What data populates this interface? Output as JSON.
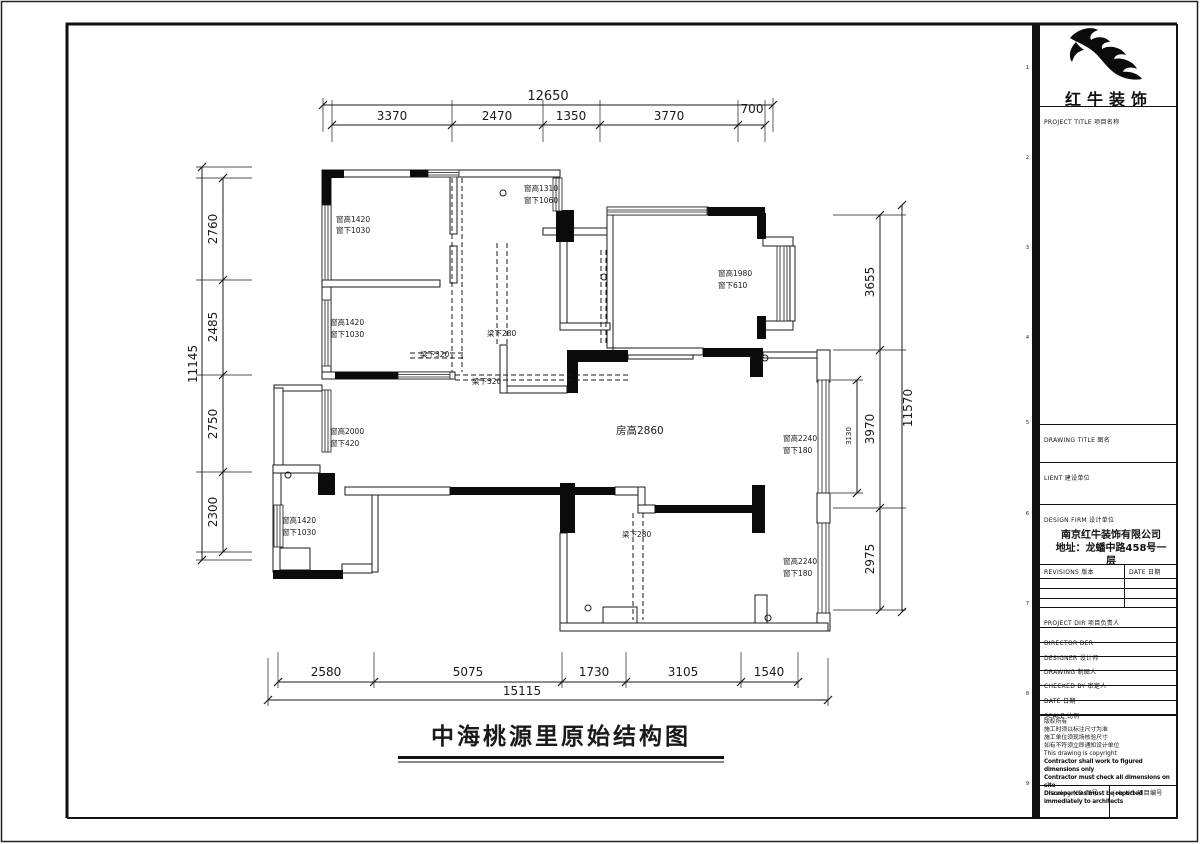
{
  "title_block": {
    "brand": "红牛装饰",
    "project_title": "PROJECT TITLE  项目名称",
    "drawing_title": "DRAWING TITLE  图名",
    "client": "LIENT  建设单位",
    "design_firm": "DESIGN FIRM  设计单位",
    "firm_name": "南京红牛装饰有限公司",
    "firm_addr1": "地址：龙蟠中路458号一",
    "firm_addr2": "层",
    "revisions": "REVISIONS  版本",
    "rev_date": "DATE  日期",
    "project_dir": "PROJECT DIR  项目负责人",
    "director": "DIRECTOR DER",
    "designer": "DESIGNER  设计师",
    "drawing": "DRAWING  制图人",
    "checked_by": "CHECKED BY  审定人",
    "date": "DATE  日期",
    "scale": "SCALE  比例",
    "notes": [
      "版权所有",
      "施工时须以标注尺寸为准",
      "施工单位须现场核验尺寸",
      "如有不符须立即通知设计单位",
      "This drawing is copyright",
      "Contractor shall work to figured dimensions only",
      "Contractor must check all dimensions on site",
      "Discrepancies must be reported immediately to architects"
    ],
    "drawing_no": "Drawing NO  图号",
    "job_no": "Job NO  项目编号",
    "grid_refs": [
      "1",
      "2",
      "3",
      "4",
      "5",
      "6",
      "7",
      "8",
      "9"
    ]
  },
  "plan": {
    "title": "中海桃源里原始结构图",
    "annotations": {
      "tl_win": {
        "l1": "窗高1420",
        "l2": "窗下1030"
      },
      "entry_win": {
        "l1": "窗高1310",
        "l2": "窗下1060"
      },
      "ml_win": {
        "l1": "窗高1420",
        "l2": "窗下1030"
      },
      "tr_win": {
        "l1": "窗高1980",
        "l2": "窗下610"
      },
      "beam_320a": "梁下320",
      "beam_280a": "梁下280",
      "beam_320b": "梁下320",
      "left_win": {
        "l1": "窗高2000",
        "l2": "窗下420"
      },
      "room_height": "房高2860",
      "right_win1": {
        "l1": "窗高2240",
        "l2": "窗下180"
      },
      "bl_win": {
        "l1": "窗高1420",
        "l2": "窗下1030"
      },
      "beam_280b": "梁下280",
      "right_win2": {
        "l1": "窗高2240",
        "l2": "窗下180"
      }
    }
  },
  "dimensions": {
    "top": {
      "total": "12650",
      "segs": [
        "3370",
        "2470",
        "1350",
        "3770",
        "700"
      ]
    },
    "left": {
      "total": "11145",
      "segs": [
        "2760",
        "2485",
        "2750",
        "2300"
      ]
    },
    "right": {
      "total": "11570",
      "segs": [
        "3655",
        "3970",
        "2975"
      ],
      "inner": "3130"
    },
    "bottom": {
      "total": "15115",
      "segs": [
        "2580",
        "5075",
        "1730",
        "3105",
        "1540"
      ]
    }
  }
}
